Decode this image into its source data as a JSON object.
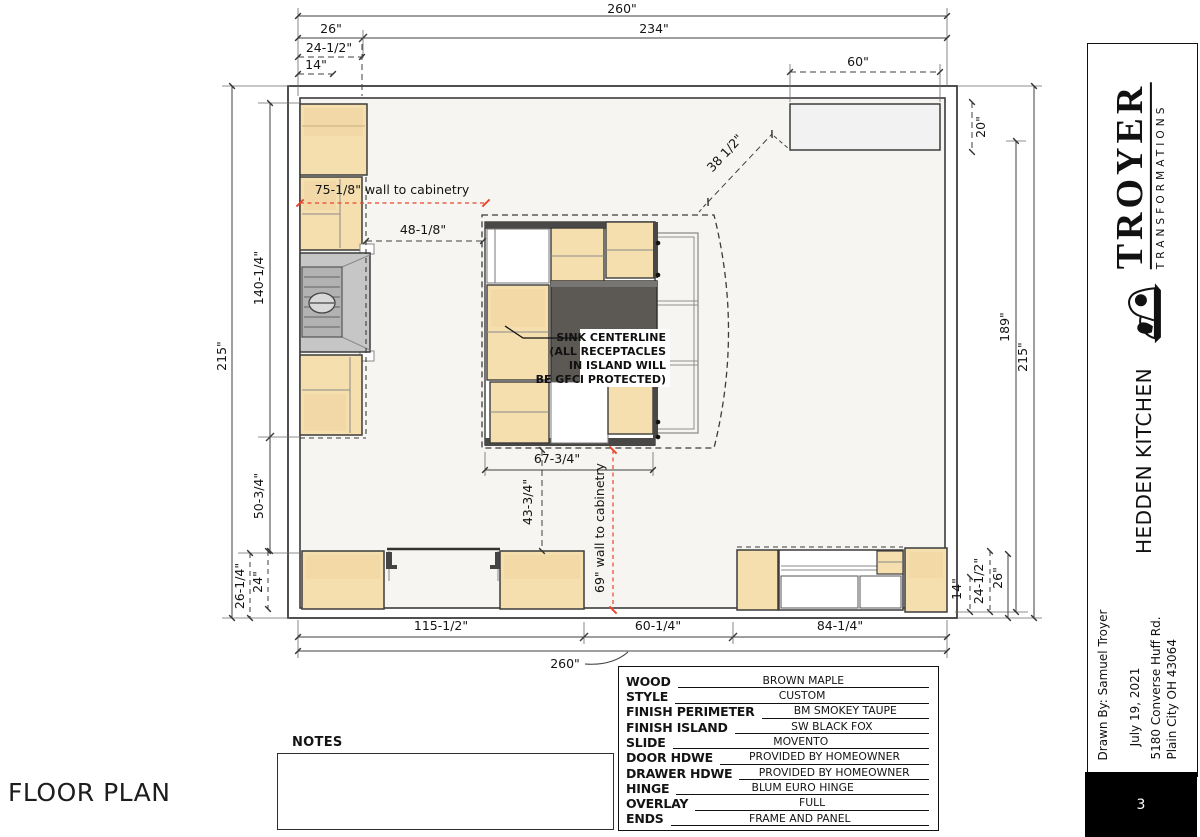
{
  "page": {
    "floor_plan_label": "FLOOR PLAN",
    "notes_label": "NOTES",
    "page_number": "3"
  },
  "title_block": {
    "company": "TROYER",
    "tagline": "TRANSFORMATIONS",
    "project": "HEDDEN KITCHEN",
    "drawn_by": "Drawn By: Samuel Troyer",
    "date": "July 19, 2021",
    "address_line1": "5180 Converse Huff Rd.",
    "address_line2": "Plain City OH 43064"
  },
  "specs": {
    "rows": [
      {
        "label": "WOOD",
        "value": "BROWN MAPLE"
      },
      {
        "label": "STYLE",
        "value": "CUSTOM"
      },
      {
        "label": "FINISH PERIMETER",
        "value": "BM SMOKEY TAUPE"
      },
      {
        "label": "FINISH ISLAND",
        "value": "SW BLACK FOX"
      },
      {
        "label": "SLIDE",
        "value": "MOVENTO"
      },
      {
        "label": "DOOR HDWE",
        "value": "PROVIDED BY HOMEOWNER"
      },
      {
        "label": "DRAWER HDWE",
        "value": "PROVIDED BY HOMEOWNER"
      },
      {
        "label": "HINGE",
        "value": "BLUM EURO HINGE"
      },
      {
        "label": "OVERLAY",
        "value": "FULL"
      },
      {
        "label": "ENDS",
        "value": "FRAME AND PANEL"
      }
    ]
  },
  "dimensions": {
    "top_overall": "260\"",
    "top_left_seg": "26\"",
    "top_main": "234\"",
    "top_cab_depth": "24-1/2\"",
    "top_cab_inner": "14\"",
    "top_fridge": "60\"",
    "right_fridge_depth": "20\"",
    "right_inner": "189\"",
    "right_overall": "215\"",
    "right_low_inner": "14\"",
    "right_low_depth": "24-1/2\"",
    "right_low_outer": "26\"",
    "left_overall": "215\"",
    "left_upper": "140-1/4\"",
    "left_lower": "50-3/4\"",
    "left_low_outer": "26-1/4\"",
    "left_low_depth": "24\"",
    "bottom_left": "115-1/2\"",
    "bottom_mid": "60-1/4\"",
    "bottom_right": "84-1/4\"",
    "bottom_overall": "260\"",
    "island_width": "67-3/4\"",
    "island_to_cab": "43-3/4\"",
    "diag_fridge": "38 1/2\"",
    "wall_to_cab_75": "75-1/8\" wall to cabinetry",
    "wall_to_cab_69": "69\" wall to cabinetry",
    "dim_48": "48-1/8\""
  },
  "annotations": {
    "sink_line1": "SINK CENTERLINE",
    "sink_line2": "(ALL RECEPTACLES",
    "sink_line3": "IN ISLAND WILL",
    "sink_line4": "BE GFCI PROTECTED)"
  },
  "colors": {
    "cabinet_fill": "#f6dfae",
    "cabinet_shade": "#eccf92",
    "island_counter_dark": "#5c5955",
    "appliance_fill": "#f2f2f2",
    "range_gray": "#c6c6c6",
    "dim_red": "#e8472e",
    "line_dark": "#3c3c3c"
  }
}
